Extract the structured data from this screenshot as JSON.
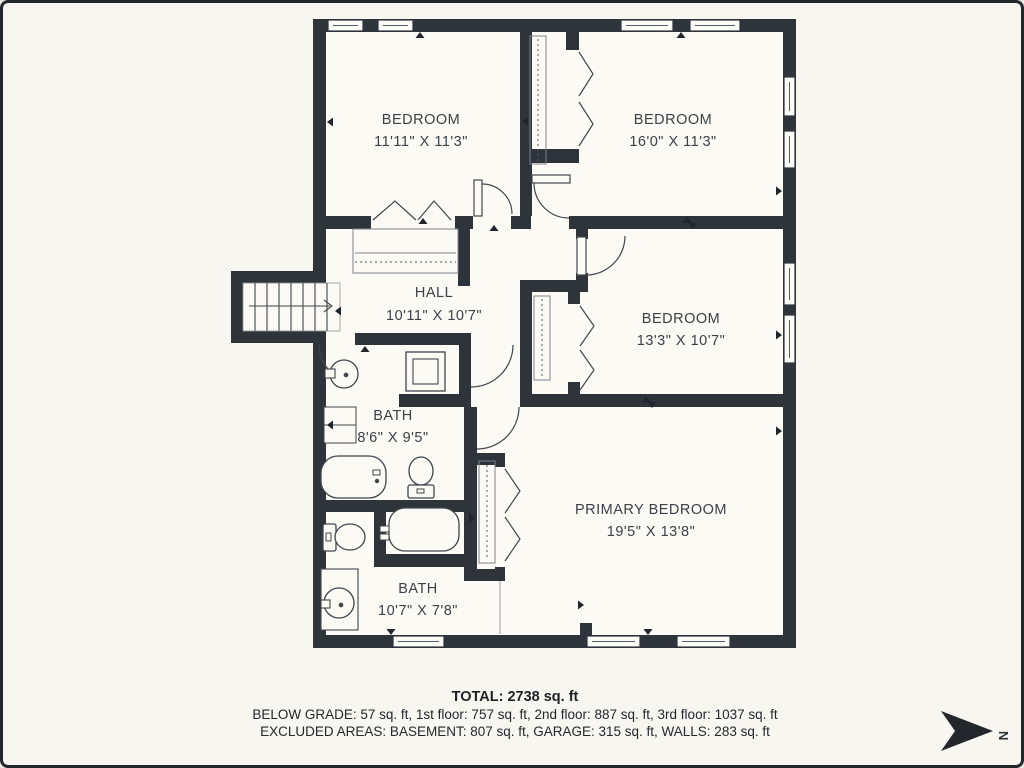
{
  "plan": {
    "rooms": [
      {
        "name": "BEDROOM",
        "dims": "11'11\" X 11'3\""
      },
      {
        "name": "BEDROOM",
        "dims": "16'0\" X 11'3\""
      },
      {
        "name": "HALL",
        "dims": "10'11\" X 10'7\""
      },
      {
        "name": "BEDROOM",
        "dims": "13'3\" X 10'7\""
      },
      {
        "name": "BATH",
        "dims": "8'6\" X 9'5\""
      },
      {
        "name": "PRIMARY BEDROOM",
        "dims": "19'5\" X 13'8\""
      },
      {
        "name": "BATH",
        "dims": "10'7\" X 7'8\""
      }
    ],
    "compass": {
      "label": "N"
    },
    "footer": {
      "total": "TOTAL: 2738 sq. ft",
      "floors": "BELOW GRADE: 57 sq. ft, 1st floor: 757 sq. ft, 2nd floor: 887 sq. ft, 3rd floor: 1037 sq. ft",
      "excluded": "EXCLUDED AREAS: BASEMENT: 807 sq. ft, GARAGE: 315 sq. ft, WALLS: 283 sq. ft"
    },
    "colors": {
      "wall": "#2e343a",
      "background": "#f7f6f0",
      "interior": "#fbfaf5",
      "line": "#40464c"
    }
  }
}
